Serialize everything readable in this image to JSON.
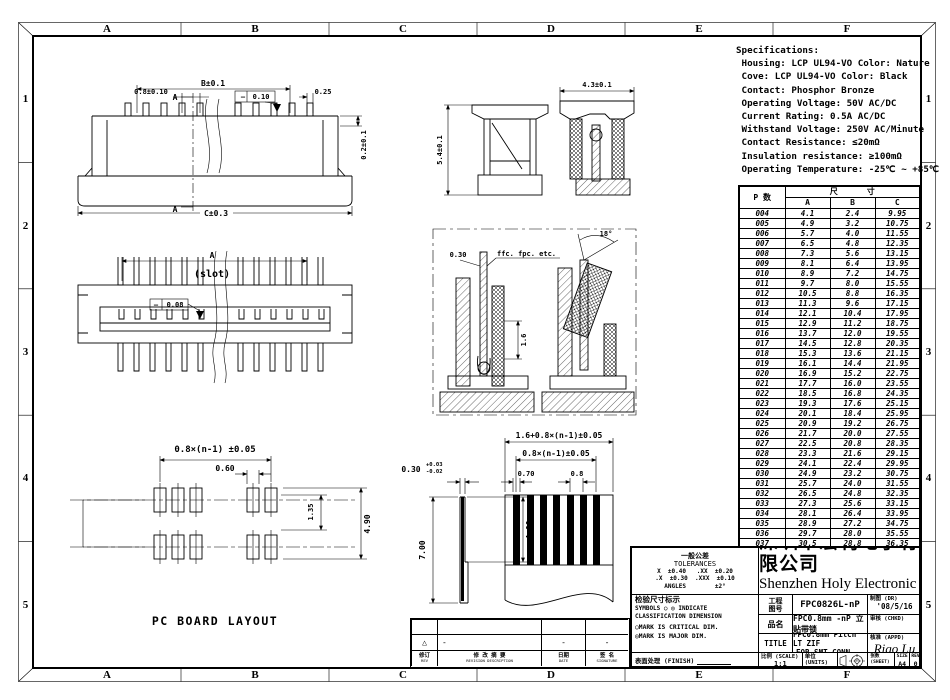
{
  "sheet": {
    "border": {
      "columns": [
        "A",
        "B",
        "C",
        "D",
        "E",
        "F"
      ],
      "rows": [
        "1",
        "2",
        "3",
        "4",
        "5"
      ]
    }
  },
  "specifications": {
    "title": "Specifications:",
    "lines": [
      " Housing: LCP UL94-VO Color: Nature",
      " Cove: LCP UL94-VO Color: Black",
      " Contact: Phosphor Bronze",
      " Operating Voltage: 50V AC/DC",
      " Current Rating: 0.5A AC/DC",
      " Withstand Voltage: 250V AC/Minute",
      " Contact Resistance: ≤20mΩ",
      " Insulation resistance: ≥100mΩ",
      " Operating Temperature: -25℃ ~ +85℃"
    ]
  },
  "parts_table": {
    "pn_header": "P 数",
    "dim_header": "尺      寸",
    "columns": [
      "A",
      "B",
      "C"
    ],
    "rows": [
      [
        "004",
        "4.1",
        "2.4",
        "9.95"
      ],
      [
        "005",
        "4.9",
        "3.2",
        "10.75"
      ],
      [
        "006",
        "5.7",
        "4.0",
        "11.55"
      ],
      [
        "007",
        "6.5",
        "4.8",
        "12.35"
      ],
      [
        "008",
        "7.3",
        "5.6",
        "13.15"
      ],
      [
        "009",
        "8.1",
        "6.4",
        "13.95"
      ],
      [
        "010",
        "8.9",
        "7.2",
        "14.75"
      ],
      [
        "011",
        "9.7",
        "8.0",
        "15.55"
      ],
      [
        "012",
        "10.5",
        "8.8",
        "16.35"
      ],
      [
        "013",
        "11.3",
        "9.6",
        "17.15"
      ],
      [
        "014",
        "12.1",
        "10.4",
        "17.95"
      ],
      [
        "015",
        "12.9",
        "11.2",
        "18.75"
      ],
      [
        "016",
        "13.7",
        "12.0",
        "19.55"
      ],
      [
        "017",
        "14.5",
        "12.8",
        "20.35"
      ],
      [
        "018",
        "15.3",
        "13.6",
        "21.15"
      ],
      [
        "019",
        "16.1",
        "14.4",
        "21.95"
      ],
      [
        "020",
        "16.9",
        "15.2",
        "22.75"
      ],
      [
        "021",
        "17.7",
        "16.0",
        "23.55"
      ],
      [
        "022",
        "18.5",
        "16.8",
        "24.35"
      ],
      [
        "023",
        "19.3",
        "17.6",
        "25.15"
      ],
      [
        "024",
        "20.1",
        "18.4",
        "25.95"
      ],
      [
        "025",
        "20.9",
        "19.2",
        "26.75"
      ],
      [
        "026",
        "21.7",
        "20.0",
        "27.55"
      ],
      [
        "027",
        "22.5",
        "20.8",
        "28.35"
      ],
      [
        "028",
        "23.3",
        "21.6",
        "29.15"
      ],
      [
        "029",
        "24.1",
        "22.4",
        "29.95"
      ],
      [
        "030",
        "24.9",
        "23.2",
        "30.75"
      ],
      [
        "031",
        "25.7",
        "24.0",
        "31.55"
      ],
      [
        "032",
        "26.5",
        "24.8",
        "32.35"
      ],
      [
        "033",
        "27.3",
        "25.6",
        "33.15"
      ],
      [
        "034",
        "28.1",
        "26.4",
        "33.95"
      ],
      [
        "035",
        "28.9",
        "27.2",
        "34.75"
      ],
      [
        "036",
        "29.7",
        "28.0",
        "35.55"
      ],
      [
        "037",
        "30.5",
        "28.8",
        "36.35"
      ],
      [
        "038",
        "31.3",
        "29.6",
        "37.15"
      ]
    ]
  },
  "drawings": {
    "front_view": {
      "dim_b": "B±0.1",
      "dim_pitch": "0.8±0.10",
      "dim_tip": "0.25",
      "dim_lip": "0.2±0.1",
      "dim_c": "C±0.3",
      "fcf_symbol": "—",
      "fcf_value": "0.10",
      "section_label": "A"
    },
    "top_view": {
      "dim_a": "A",
      "slot_label": "(slot)",
      "fcf_symbol": "—",
      "fcf_value": "0.08"
    },
    "side_views": {
      "dim_height": "5.4±0.1",
      "dim_width": "4.3±0.1"
    },
    "detail_box": {
      "dim_thickness": "0.30",
      "cable_label": "ffc. fpc. etc.",
      "dim_depth": "1.6",
      "dim_angle": "18°"
    },
    "pcb_layout": {
      "dim_span": "0.8×(n-1) ±0.05",
      "dim_pad_width": "0.60",
      "dim_pad_len": "1.35",
      "dim_outer": "4.90",
      "caption": "PC BOARD LAYOUT"
    },
    "fpc_side": {
      "dim_thickness": "0.30",
      "tol_plus": "+0.03",
      "tol_minus": "-0.02",
      "dim_length": "7.00",
      "dim_exposed": "4.00"
    },
    "ffc_view": {
      "dim_overall": "1.6+0.8×(n-1)±0.05",
      "dim_span": "0.8×(n-1)±0.05",
      "dim_conductor": "0.70",
      "dim_pitch": "0.8"
    }
  },
  "title_block": {
    "tolerances": {
      "title_cn": "一般公差",
      "title_en": "TOLERANCES",
      "line1": "X  ±0.40   .XX  ±0.20",
      "line2": ".X  ±0.30  .XXX  ±0.10",
      "line3": "ANGLES        ±2°"
    },
    "company_cn": "深圳市宏利电子有限公司",
    "company_en": "Shenzhen Holy Electronic Co.,Ltd",
    "inspection": {
      "title": "检验尺寸标示",
      "line1": "SYMBOLS ○ ◎ INDICATE",
      "line2": "CLASSIFICATION DIMENSION",
      "line3": "○MARK IS CRITICAL DIM.",
      "line4": "◎MARK IS MAJOR DIM."
    },
    "finish_label": "表面处理 (FINISH)",
    "partno_label_1": "工程",
    "partno_label_2": "图号",
    "partno_value": "FPC0826L-nP",
    "product_label": "品名",
    "product_value": "FPC0.8mm -nP 立贴带锁",
    "title_label": "TITLE",
    "title_value_1": "FPC0.8mm Pitch LT ZIF",
    "title_value_2": "FOR SMT  CONN",
    "dr_label": "制图 (DR)",
    "dr_value": "'08/5/16",
    "chkd_label": "审核 (CHKD)",
    "chkd_value": "",
    "appd_label": "核准 (APPD)",
    "appd_value": "Rigo Lu",
    "scale_label": "比例 (SCALE)",
    "scale_value": "1:1",
    "units_label": "单位 (UNITS)",
    "units_value": "mm",
    "sheet_label": "张数 (SHEET)",
    "sheet_value": "1 OF 1",
    "size_label": "SIZE",
    "size_value": "A4",
    "rev_label": "REV",
    "rev_value": "0"
  },
  "revision_strip": {
    "marks": {
      "triangle": "△",
      "desc": "-",
      "date": "-",
      "sign": "-"
    },
    "headers": [
      {
        "cn": "修订",
        "en": "REV"
      },
      {
        "cn": "修 改 摘 要",
        "en": "REVISION DESCRIPTION"
      },
      {
        "cn": "日期",
        "en": "DATE"
      },
      {
        "cn": "签 名",
        "en": "SIGNATURE"
      }
    ]
  }
}
